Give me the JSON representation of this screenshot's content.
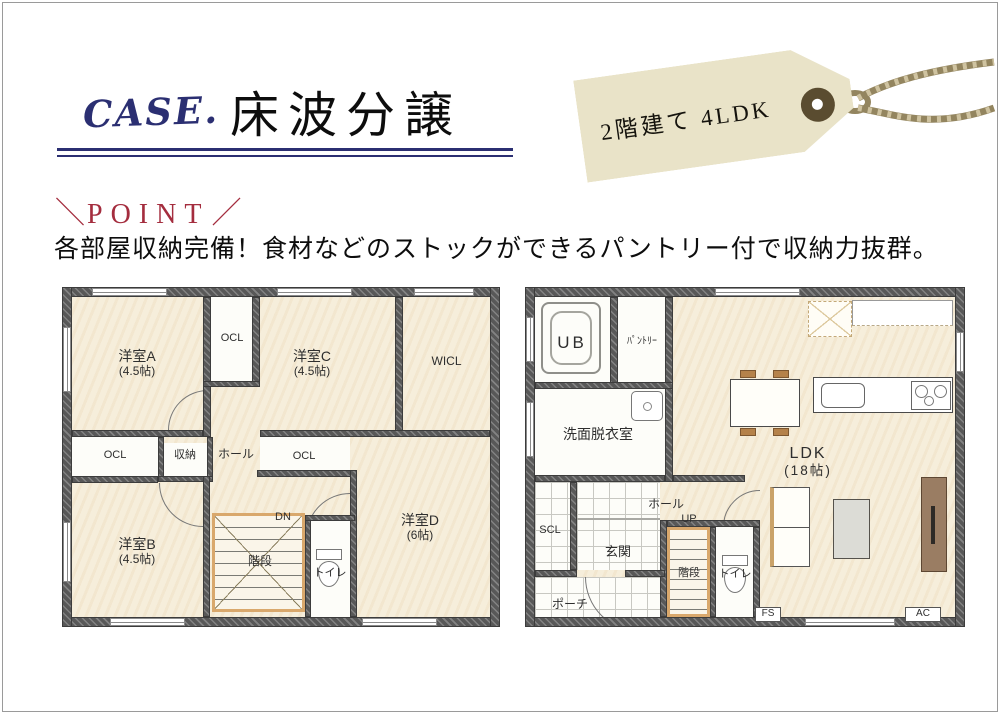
{
  "header": {
    "case_label": "CASE.",
    "title": "床波分譲"
  },
  "tag": {
    "line": "2階建て 4LDK"
  },
  "point": {
    "open": "＼",
    "label": "POINT",
    "close": "／"
  },
  "description": "各部屋収納完備！食材などのストックができるパントリー付で収納力抜群。",
  "colors": {
    "accent_navy": "#2b2f72",
    "accent_red": "#a42d3e",
    "tag_bg": "#e9e3c8",
    "tag_hole": "#5a4c30",
    "string": "#93855f",
    "wall": "#585858",
    "floor_cream": "#f6eedb",
    "stair_frame": "#d9a86c",
    "wood": "#9a7d63"
  },
  "floor2": {
    "rooms": [
      {
        "label": "洋室A",
        "size": "(4.5帖)"
      },
      {
        "label": "OCL"
      },
      {
        "label": "洋室C",
        "size": "(4.5帖)"
      },
      {
        "label": "WICL"
      },
      {
        "label": "OCL"
      },
      {
        "label": "収納"
      },
      {
        "label": "ホール"
      },
      {
        "label": "OCL"
      },
      {
        "label": "洋室B",
        "size": "(4.5帖)"
      },
      {
        "label": "階段"
      },
      {
        "label": "DN"
      },
      {
        "label": "トイレ"
      },
      {
        "label": "洋室D",
        "size": "(6帖)"
      }
    ]
  },
  "floor1": {
    "rooms": [
      {
        "label": "UB"
      },
      {
        "label": "ﾊﾟﾝﾄﾘｰ"
      },
      {
        "label": "洗面脱衣室"
      },
      {
        "label": "LDK",
        "size": "(18帖)"
      },
      {
        "label": "ホール"
      },
      {
        "label": "UP"
      },
      {
        "label": "SCL"
      },
      {
        "label": "玄関"
      },
      {
        "label": "階段"
      },
      {
        "label": "トイレ"
      },
      {
        "label": "ポーチ"
      },
      {
        "label": "FS"
      },
      {
        "label": "AC"
      }
    ]
  }
}
